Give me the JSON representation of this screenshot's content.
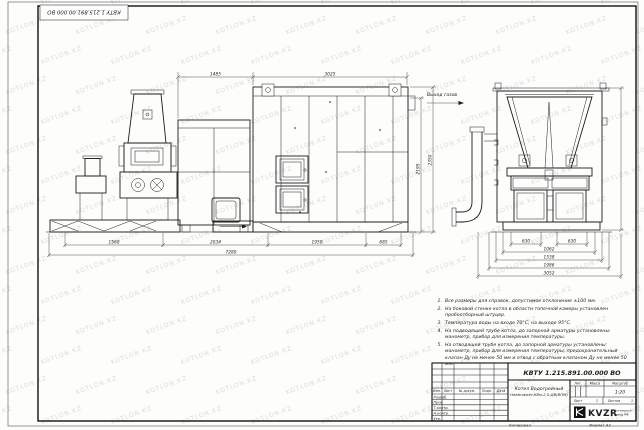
{
  "watermark": {
    "text": "KOTLON.KZ"
  },
  "stamp": {
    "designation_rotated": "КВТУ 1.215.891.00.000 ВО"
  },
  "drawing": {
    "gas_exit_label": "Выход газов",
    "dims": {
      "front_top": [
        "1485",
        "3025"
      ],
      "front_right": [
        "2195",
        "2350"
      ],
      "front_bottom": [
        "1560",
        "2034",
        "1950",
        "685"
      ],
      "front_total": "7280",
      "side_bottom": [
        "630",
        "630",
        "1062",
        "1538",
        "1986",
        "3052"
      ]
    }
  },
  "notes": [
    {
      "n": "1.",
      "text": "Все размеры для справок, допустимое отклонение ±100 мм."
    },
    {
      "n": "2.",
      "text": "На боковой стенке котла в области топочной камеры установлен пробоотборный штуцер."
    },
    {
      "n": "3.",
      "text": "Температура воды на входе 70°С, на выходе 95°С."
    },
    {
      "n": "4.",
      "text": "На подводящей трубе котла, до запорной арматуры установлены: манометр, прибор для измерения температуры."
    },
    {
      "n": "5.",
      "text": "На отводящей трубе котла, до запорной арматуры установлены: манометр, прибор для измерения температуры, предохранительный клапан Ду не менее 50 мм и отвод с обратным клапаном Ду не менее 50 мм."
    }
  ],
  "title_block": {
    "designation": "КВТУ 1.215.891.00.000 ВО",
    "product_name_line1": "Котел Водогрейный",
    "product_name_line2": "Heatmaster-КВм-2,5-ДВ(ВПМ)",
    "header_cols": [
      "Изм.",
      "Лист",
      "№ докум.",
      "Подп.",
      "Дата"
    ],
    "sig_rows": [
      "Разраб.",
      "Пров.",
      "Т.контр.",
      "Н.контр.",
      "Утв."
    ],
    "lit_label": "Лит.",
    "mass_label": "Масса",
    "scale_label": "Масштаб",
    "scale_value": "1:20",
    "sheet_label": "Лист",
    "sheet_value": "1",
    "sheets_label": "Листов",
    "sheets_value": "1",
    "logo_text": "KVZR",
    "logo_caption_line1": "Котельный",
    "logo_caption_line2": "завод РФ"
  },
  "footer": {
    "copied_label": "Копировал",
    "format_label": "Формат А2"
  }
}
